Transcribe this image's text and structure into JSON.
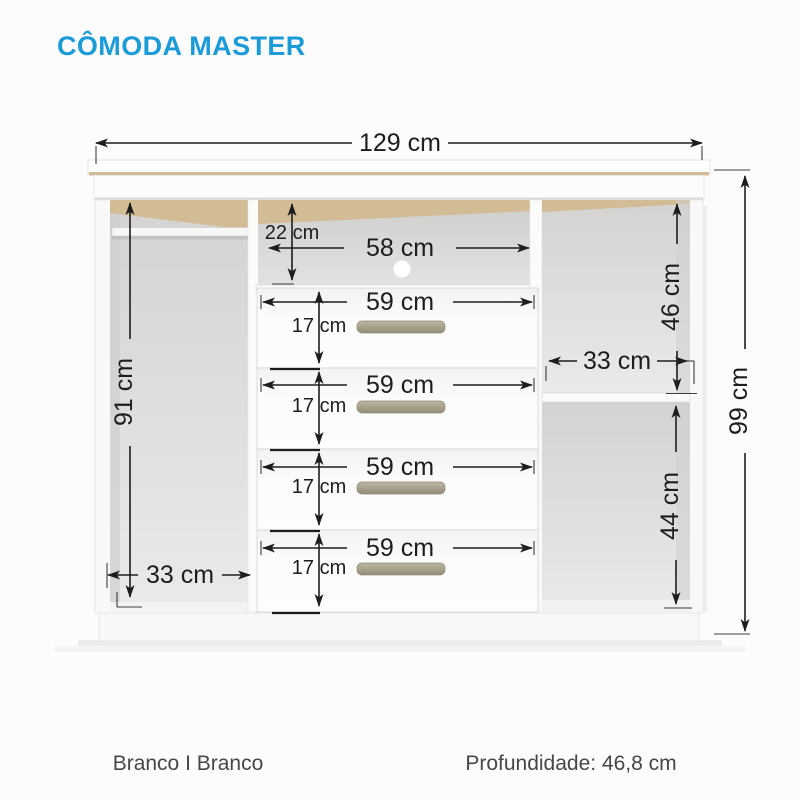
{
  "title": "CÔMODA MASTER",
  "colors": {
    "accent": "#1b9cd8",
    "dim": "#1d1d1b",
    "text": "#474747",
    "handle": "#a59f8b",
    "wood": "#d2bc96"
  },
  "footer": {
    "finish": "Branco I Branco",
    "depth": "Profundidade: 46,8 cm"
  },
  "dimensions": {
    "overall_width": "129 cm",
    "overall_height": "99 cm",
    "left_section_height": "91 cm",
    "left_section_width": "33 cm",
    "niche_height": "22 cm",
    "niche_width": "58 cm",
    "right_upper_height": "46 cm",
    "right_section_width": "33 cm",
    "right_lower_height": "44 cm",
    "drawers": [
      {
        "width": "59 cm",
        "height": "17 cm"
      },
      {
        "width": "59 cm",
        "height": "17 cm"
      },
      {
        "width": "59 cm",
        "height": "17 cm"
      },
      {
        "width": "59 cm",
        "height": "17 cm"
      }
    ]
  }
}
